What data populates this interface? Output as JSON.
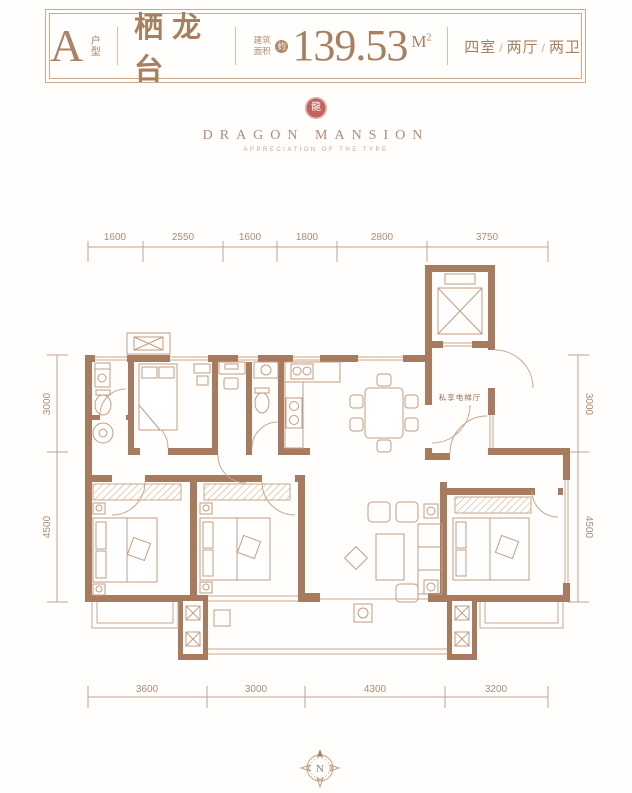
{
  "header": {
    "unit_type": "A",
    "unit_type_label": "户型",
    "project_name": "栖龙台",
    "area_label": "建筑面积",
    "area_approx": "约",
    "area_value": "139.53",
    "area_unit": "M",
    "area_unit_exponent": "2",
    "layout": {
      "rooms": "四室",
      "sep1": "/",
      "halls": "两厅",
      "sep2": "/",
      "baths": "两卫"
    }
  },
  "logo": {
    "seal_char": "龍",
    "name": "DRAGON MANSION",
    "tagline": "APPRECIATION OF THE TYPE"
  },
  "plan": {
    "labels": {
      "elevator_hall": "私享电梯厅"
    },
    "dimensions": {
      "top": [
        "1600",
        "2550",
        "1600",
        "1800",
        "2800",
        "3750"
      ],
      "bottom": [
        "3600",
        "3000",
        "4300",
        "3200"
      ],
      "left": [
        "3000",
        "4500"
      ],
      "right": [
        "3000",
        "4500"
      ]
    },
    "compass": {
      "letter": "N"
    }
  },
  "colors": {
    "wall": "#a87b5e",
    "thin_line": "#c9a78b",
    "dim_text": "#b18a6e",
    "header_text": "#a8805f",
    "seal_red": "#c4625c"
  }
}
